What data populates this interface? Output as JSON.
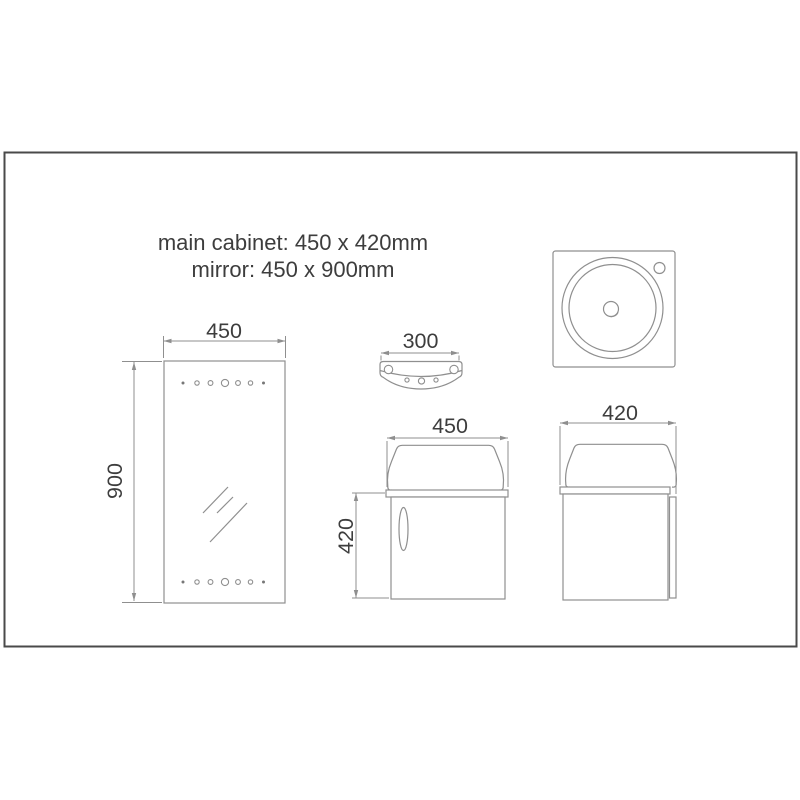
{
  "title": {
    "line1": "main cabinet: 450 x 420mm",
    "line2": "mirror: 450 x 900mm"
  },
  "dimensions": {
    "mirror_width": "450",
    "mirror_height": "900",
    "shelf_width": "300",
    "cabinet_front_width": "450",
    "cabinet_front_height": "420",
    "cabinet_side_depth": "420"
  },
  "colors": {
    "border": "#4a4a4a",
    "line": "#8f8f8f",
    "text": "#3d3d3d",
    "background": "#ffffff"
  }
}
